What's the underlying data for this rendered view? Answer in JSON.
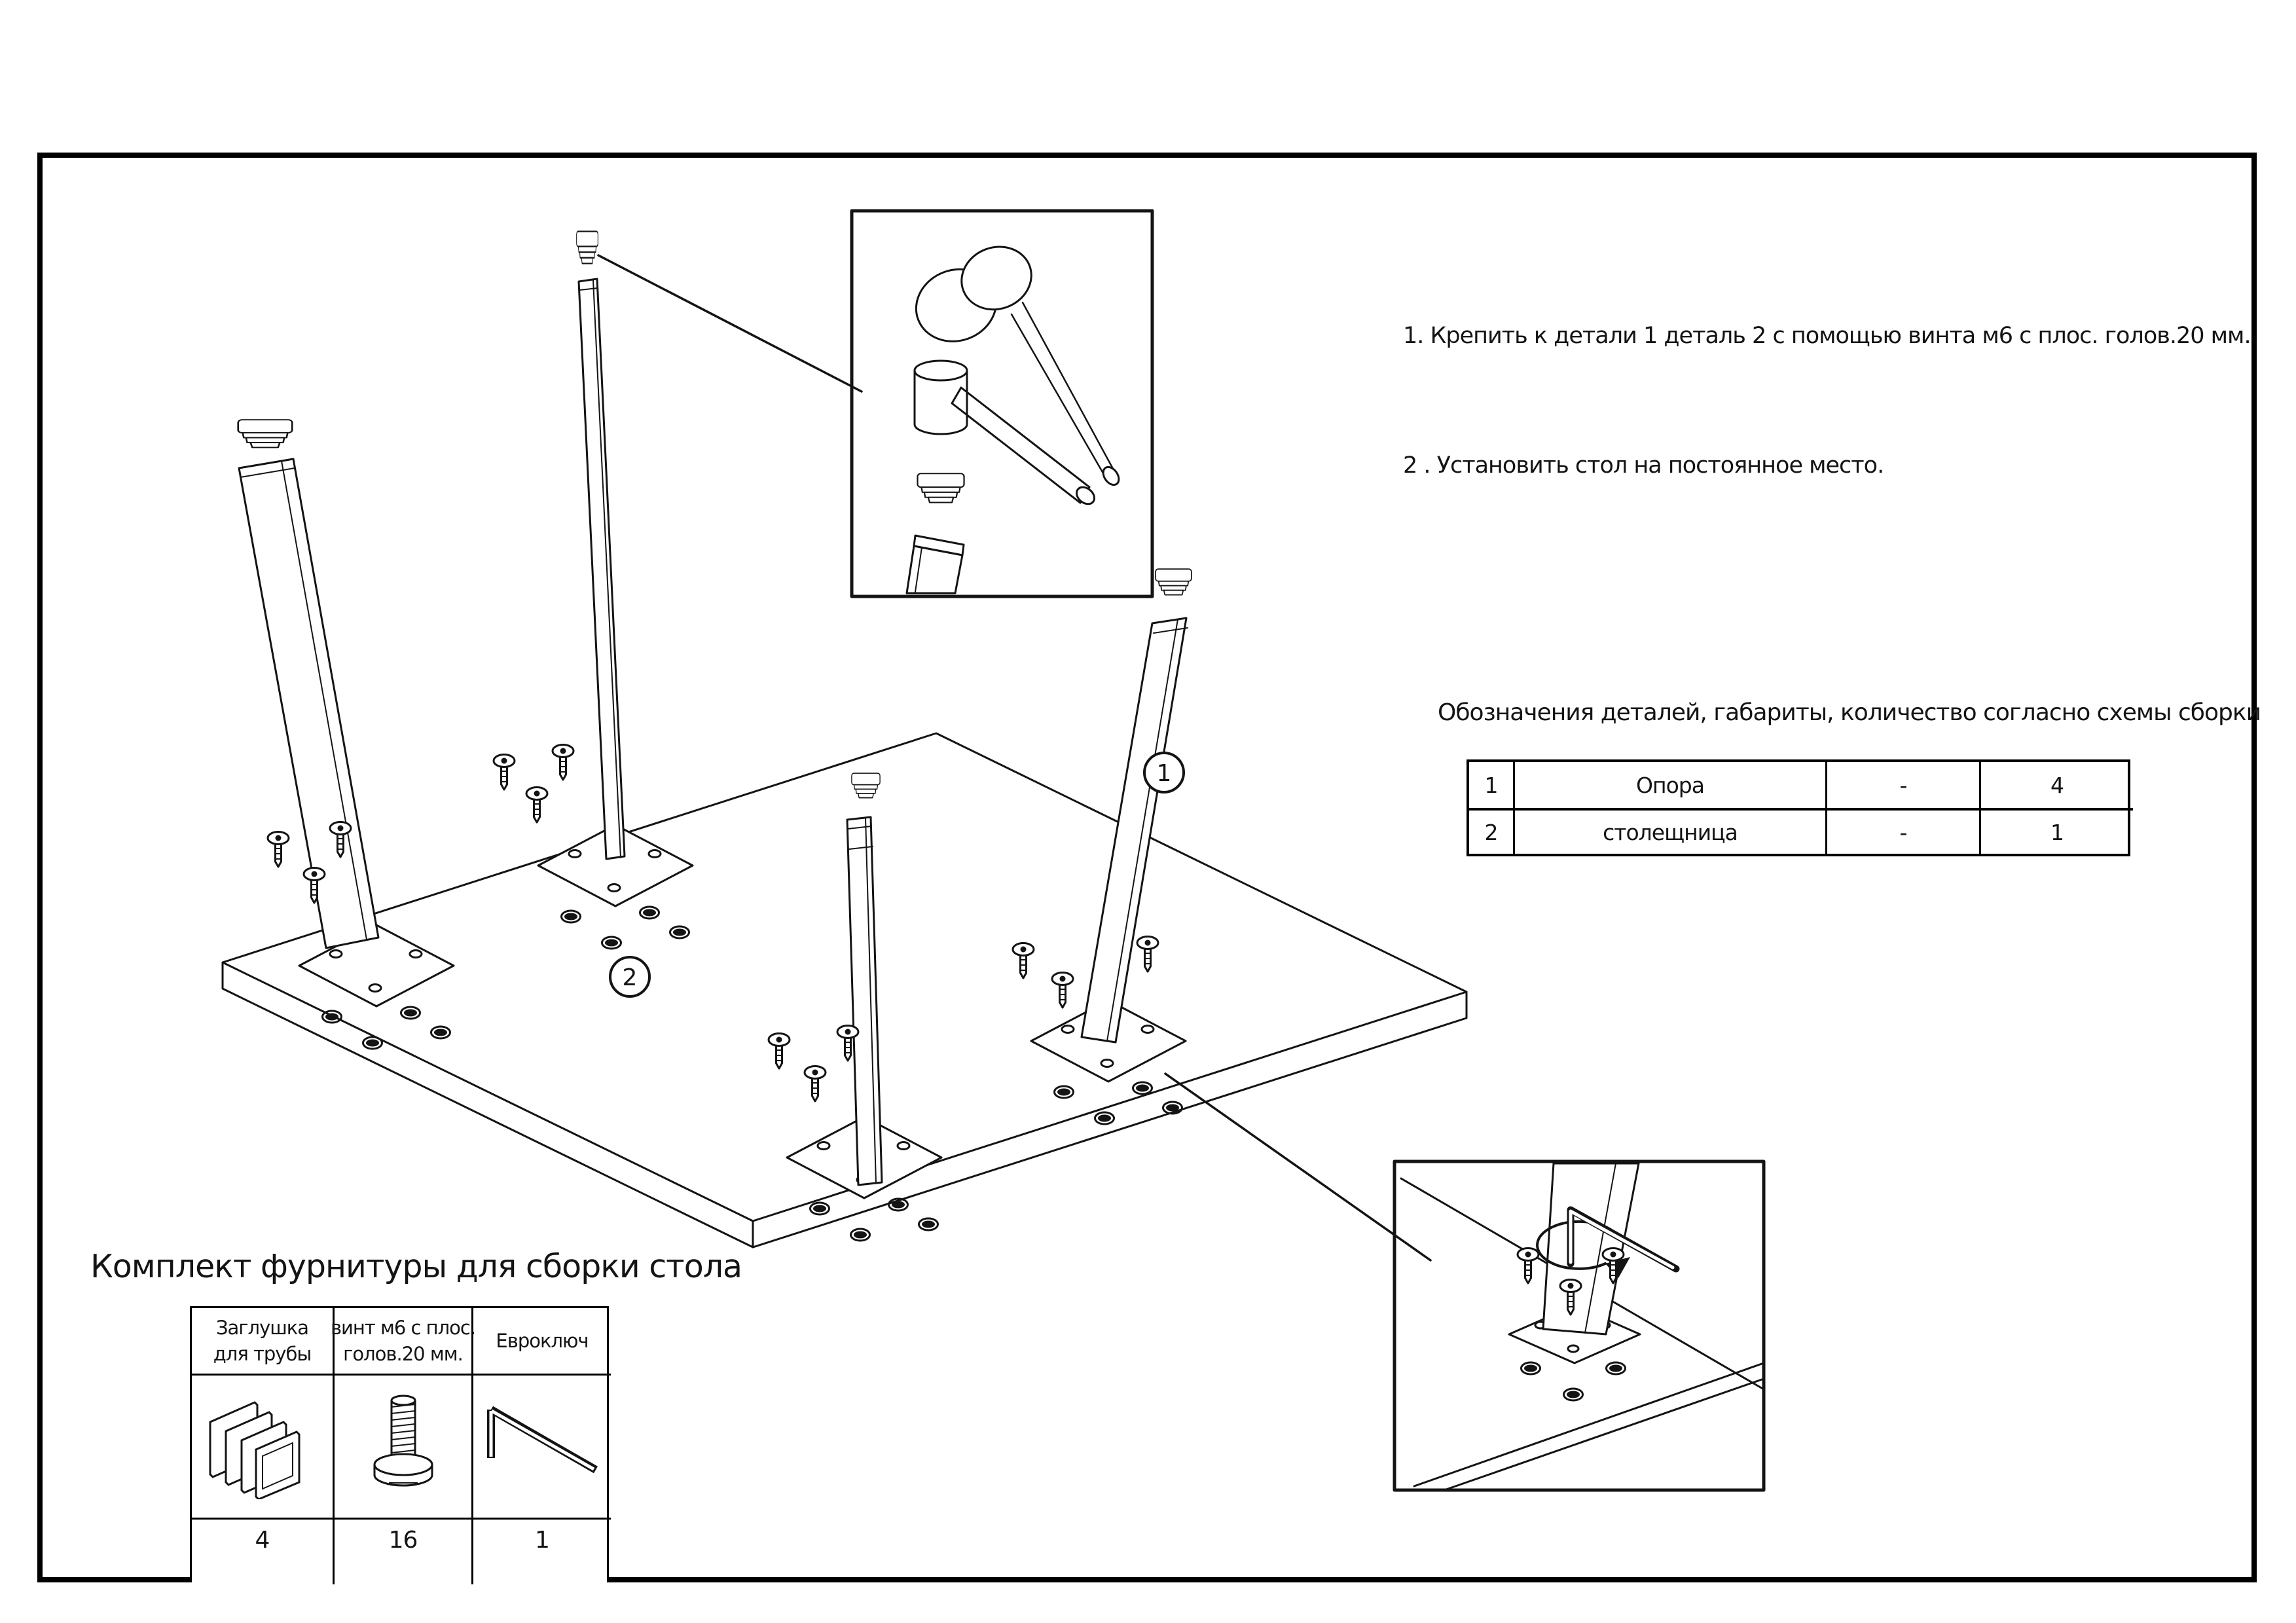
{
  "instructions": {
    "line1": "1. Крепить к детали 1 деталь 2 с помощью винта м6 с плос. голов.20 мм.",
    "line2": "2 . Установить стол на постоянное место."
  },
  "parts_list": {
    "title": "Обозначения деталей, габариты, количество согласно схемы сборки",
    "rows": [
      {
        "num": "1",
        "name": "Опора",
        "dims": "-",
        "qty": "4"
      },
      {
        "num": "2",
        "name": "столещница",
        "dims": "-",
        "qty": "1"
      }
    ]
  },
  "hardware_kit": {
    "title": "Комплект фурнитуры для сборки стола",
    "columns": [
      {
        "line1": "Заглушка",
        "line2": "для трубы",
        "qty": "4"
      },
      {
        "line1": "винт м6 с плос.",
        "line2": "голов.20 мм.",
        "qty": "16"
      },
      {
        "line1": "Евроключ",
        "line2": "",
        "qty": "1"
      }
    ]
  },
  "diagram": {
    "leg_callout": "1",
    "top_callout": "2"
  },
  "colors": {
    "line": "#141414",
    "background": "#ffffff"
  }
}
